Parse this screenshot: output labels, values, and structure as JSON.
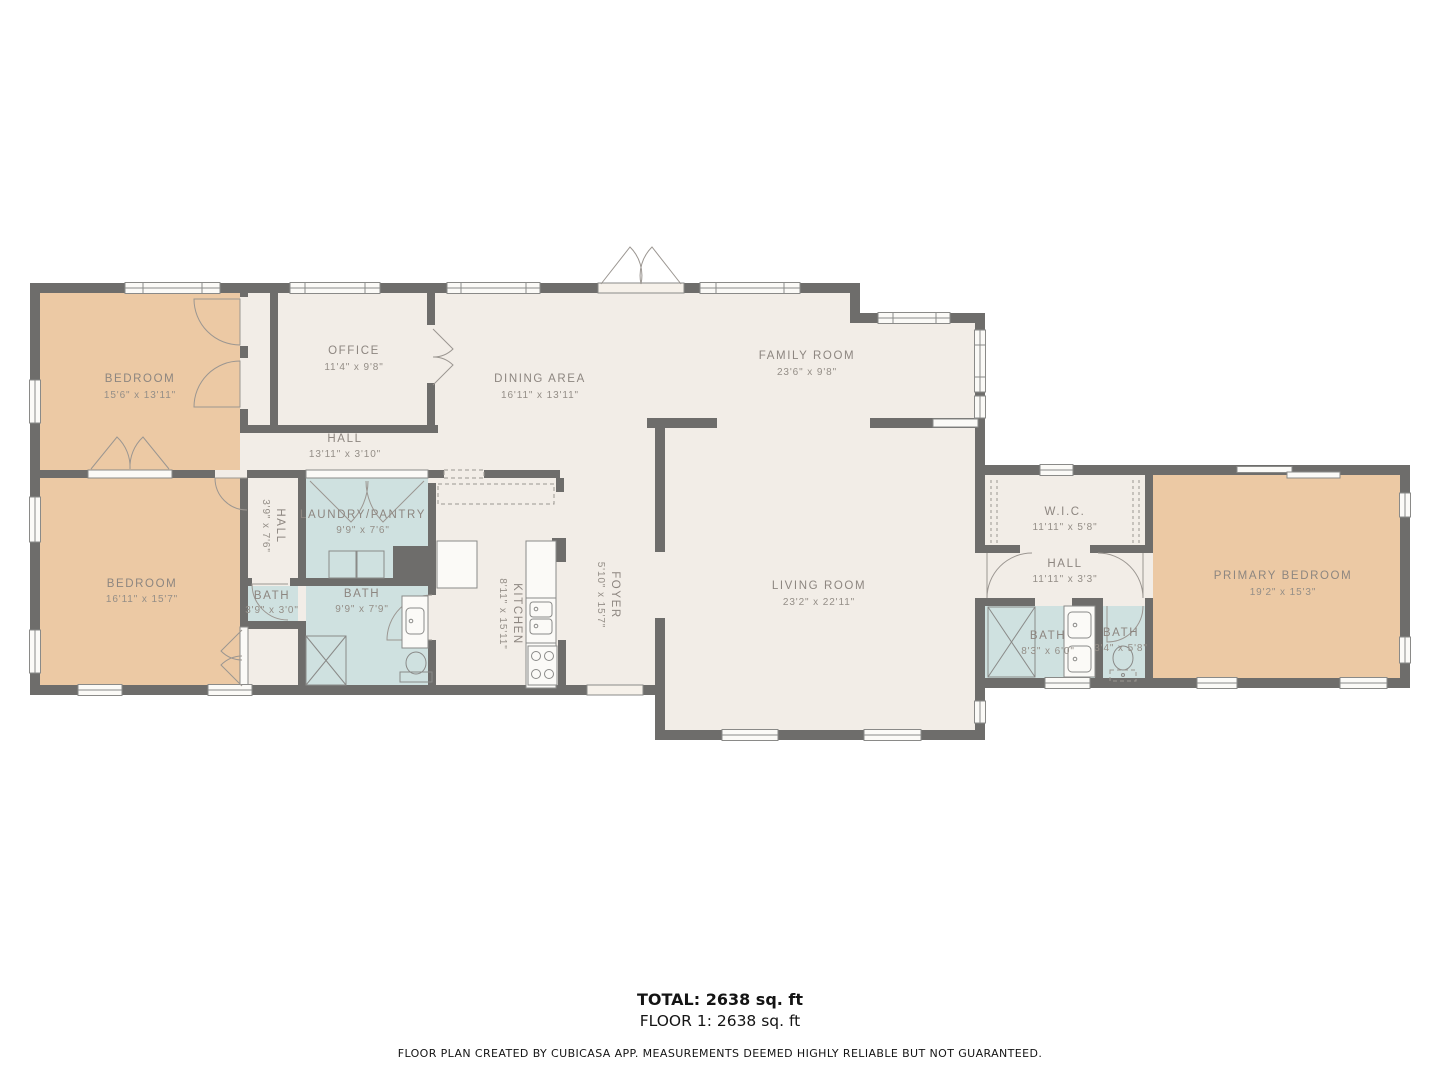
{
  "rooms": {
    "bedroom_top_left": {
      "name": "BEDROOM",
      "dims": "15'6\" x 13'11\""
    },
    "office": {
      "name": "OFFICE",
      "dims": "11'4\" x 9'8\""
    },
    "dining_area": {
      "name": "DINING AREA",
      "dims": "16'11\" x 13'11\""
    },
    "family_room": {
      "name": "FAMILY ROOM",
      "dims": "23'6\" x 9'8\""
    },
    "hall_main": {
      "name": "HALL",
      "dims": "13'11\" x 3'10\""
    },
    "bedroom_bottom_left": {
      "name": "BEDROOM",
      "dims": "16'11\" x 15'7\""
    },
    "hall_small": {
      "name": "HALL",
      "dims": "3'9\" x 7'6\""
    },
    "laundry_pantry": {
      "name": "LAUNDRY/PANTRY",
      "dims": "9'9\" x 7'6\""
    },
    "bath_powder": {
      "name": "BATH",
      "dims": "3'9\" x 3'0\""
    },
    "bath_main_left": {
      "name": "BATH",
      "dims": "9'9\" x 7'9\""
    },
    "kitchen": {
      "name": "KITCHEN",
      "dims": "8'11\" x 15'11\""
    },
    "foyer": {
      "name": "FOYER",
      "dims": "5'10\" x 15'7\""
    },
    "living_room": {
      "name": "LIVING ROOM",
      "dims": "23'2\" x 22'11\""
    },
    "wic": {
      "name": "W.I.C.",
      "dims": "11'11\" x 5'8\""
    },
    "hall_right": {
      "name": "HALL",
      "dims": "11'11\" x 3'3\""
    },
    "bath_right_large": {
      "name": "BATH",
      "dims": "8'3\" x 6'0\""
    },
    "bath_right_small": {
      "name": "BATH",
      "dims": "3'4\" x 5'8\""
    },
    "primary_bedroom": {
      "name": "PRIMARY BEDROOM",
      "dims": "19'2\" x 15'3\""
    }
  },
  "footer": {
    "total": "TOTAL: 2638 sq. ft",
    "floor": "FLOOR 1: 2638 sq. ft",
    "disclaimer": "FLOOR PLAN CREATED BY CUBICASA APP. MEASUREMENTS DEEMED HIGHLY RELIABLE BUT NOT GUARANTEED."
  },
  "colors": {
    "wall": "#6e6d6b",
    "floor": "#f2ede7",
    "bedroom_fill": "#ecc9a4",
    "wet_room_fill": "#cfe1e0",
    "window_fill": "#fbfaf7",
    "line": "#8a8a88",
    "label_text": "#8d8680",
    "footer_text": "#141414"
  }
}
